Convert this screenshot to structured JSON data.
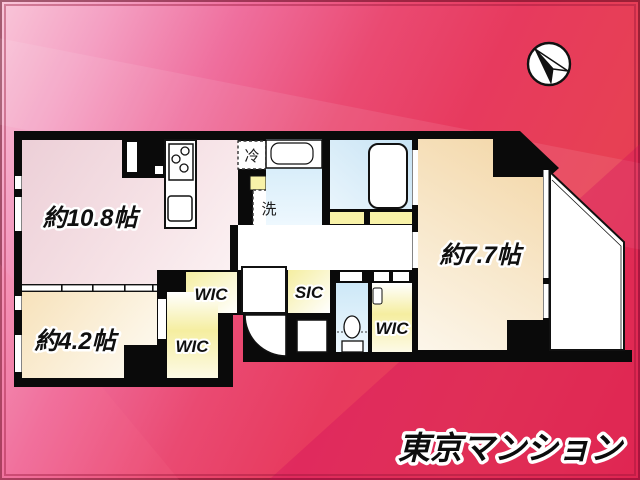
{
  "plan": {
    "rooms": {
      "ldk": {
        "label": "約10.8帖"
      },
      "bedroom_77": {
        "label": "約7.7帖"
      },
      "bedroom_42": {
        "label": "約4.2帖"
      },
      "wic_top": {
        "label": "WIC"
      },
      "wic_left": {
        "label": "WIC"
      },
      "wic_right": {
        "label": "WIC"
      },
      "sic": {
        "label": "SIC"
      },
      "fridge": {
        "label": "冷"
      },
      "washer": {
        "label": "洗"
      }
    },
    "fixtures": [
      "kitchen-stove",
      "kitchen-sink",
      "washbasin",
      "bathtub",
      "toilet",
      "entrance-door",
      "balcony"
    ],
    "compass": {
      "icon": "north-arrow"
    }
  },
  "branding": {
    "logo": "東京マンション"
  },
  "colors": {
    "background_top": "#f9c6d9",
    "background_bottom": "#e6334e",
    "wall": "#0a0a0a",
    "floor_ldk": "#efd2d9",
    "floor_bedroom": "#f3d7a9",
    "floor_closet": "#f6efa0",
    "floor_wet": "#cde8f7",
    "threshold": "#f8f2a8"
  }
}
